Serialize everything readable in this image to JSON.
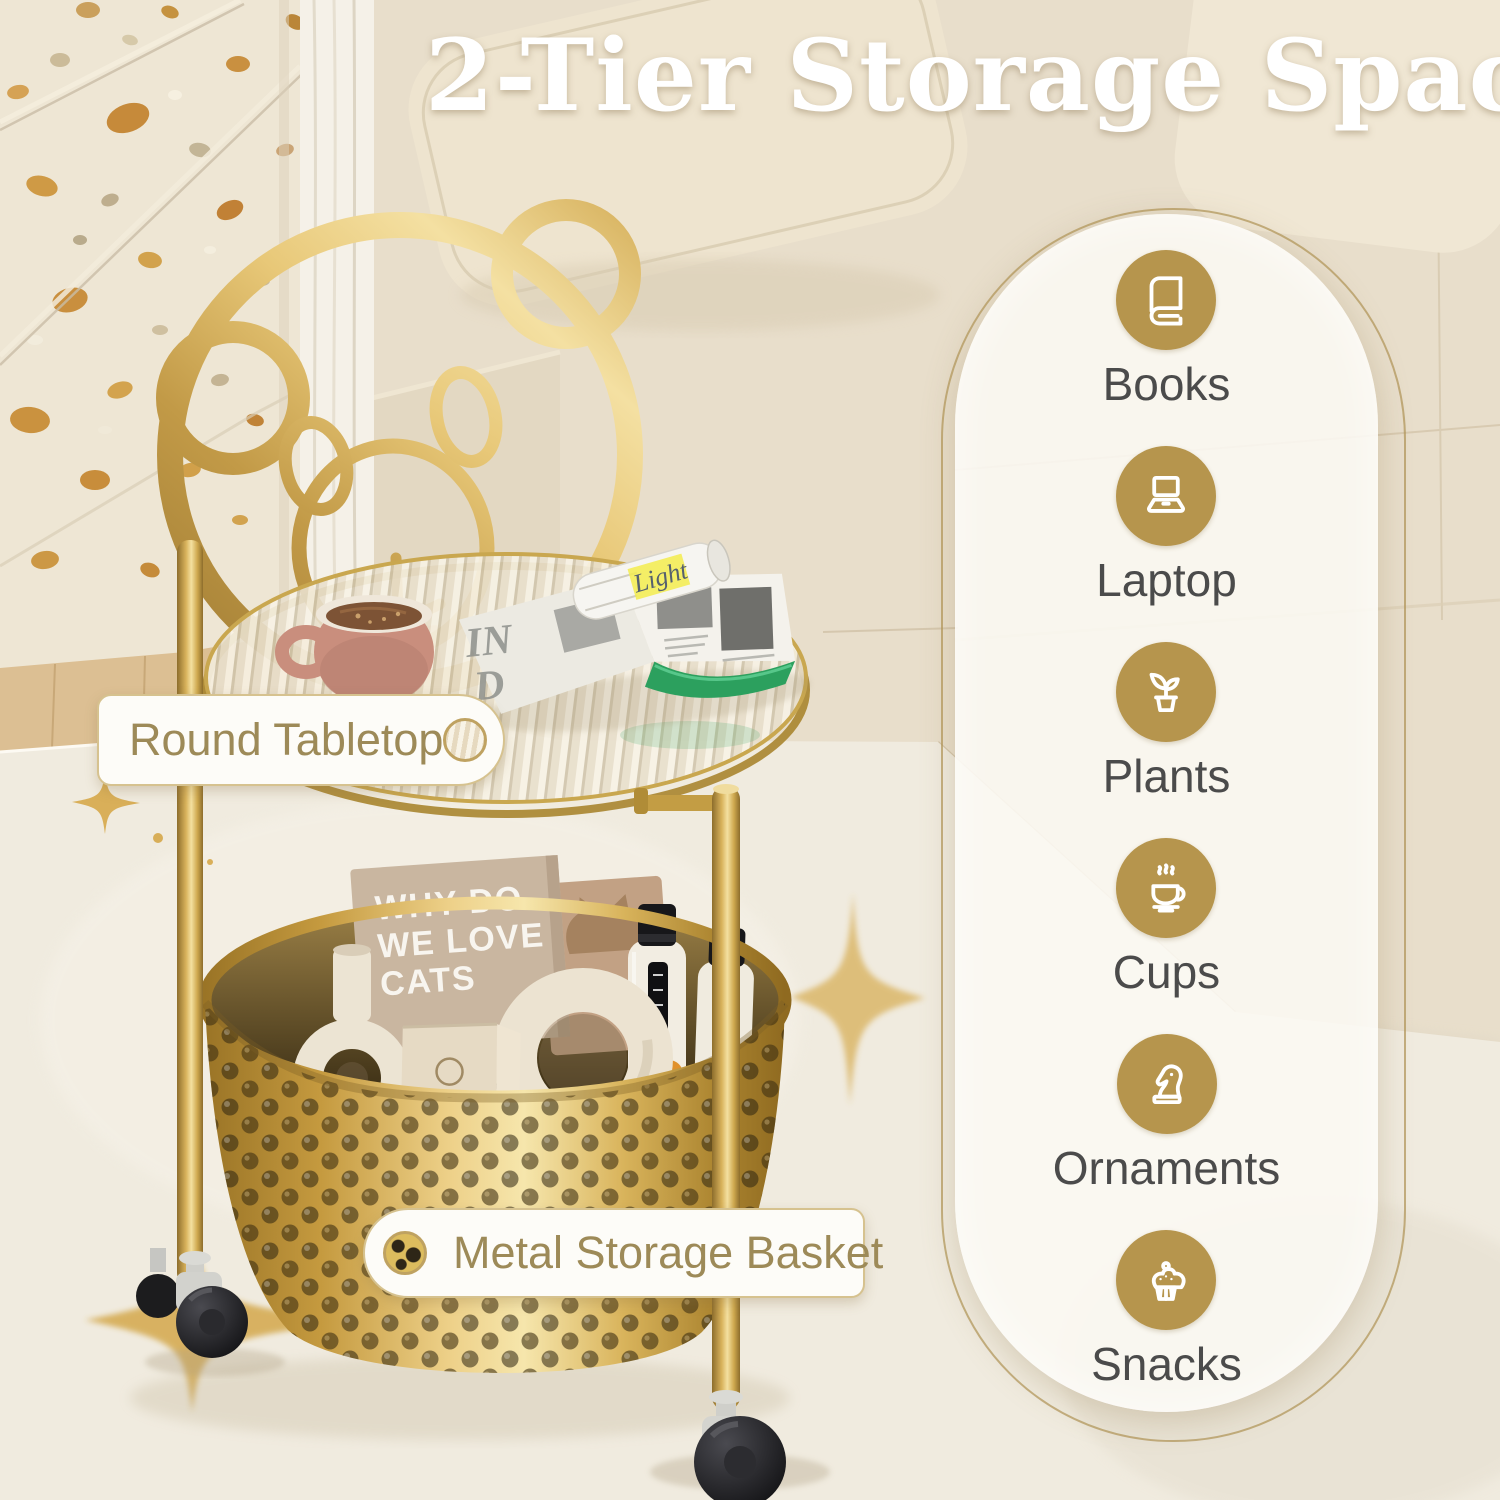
{
  "title": "2-Tier Storage Space",
  "callouts": {
    "tabletop": "Round Tabletop",
    "basket": "Metal Storage Basket"
  },
  "features": [
    {
      "label": "Books",
      "icon": "book-icon"
    },
    {
      "label": "Laptop",
      "icon": "laptop-icon"
    },
    {
      "label": "Plants",
      "icon": "plant-icon"
    },
    {
      "label": "Cups",
      "icon": "coffee-cup-icon"
    },
    {
      "label": "Ornaments",
      "icon": "chess-knight-icon"
    },
    {
      "label": "Snacks",
      "icon": "cupcake-icon"
    }
  ],
  "scene": {
    "book_cover": {
      "line1": "WHY DO",
      "line2": "WE LOVE",
      "line3": "CATS"
    },
    "bag_text": "BLANCHARD'S",
    "magazine_cover": {
      "line1": "IN",
      "line2": "D"
    },
    "magazine_highlight": "Light"
  },
  "colors": {
    "accent_gold": "#B6954D",
    "feature_label_gray": "#4B4B4B",
    "callout_text_gold": "#9D8A58",
    "callout_border": "#D6C28F",
    "title_white": "#FFFFFF",
    "frame_gold": "#D9B563",
    "basket_gold": "#D8B359"
  }
}
